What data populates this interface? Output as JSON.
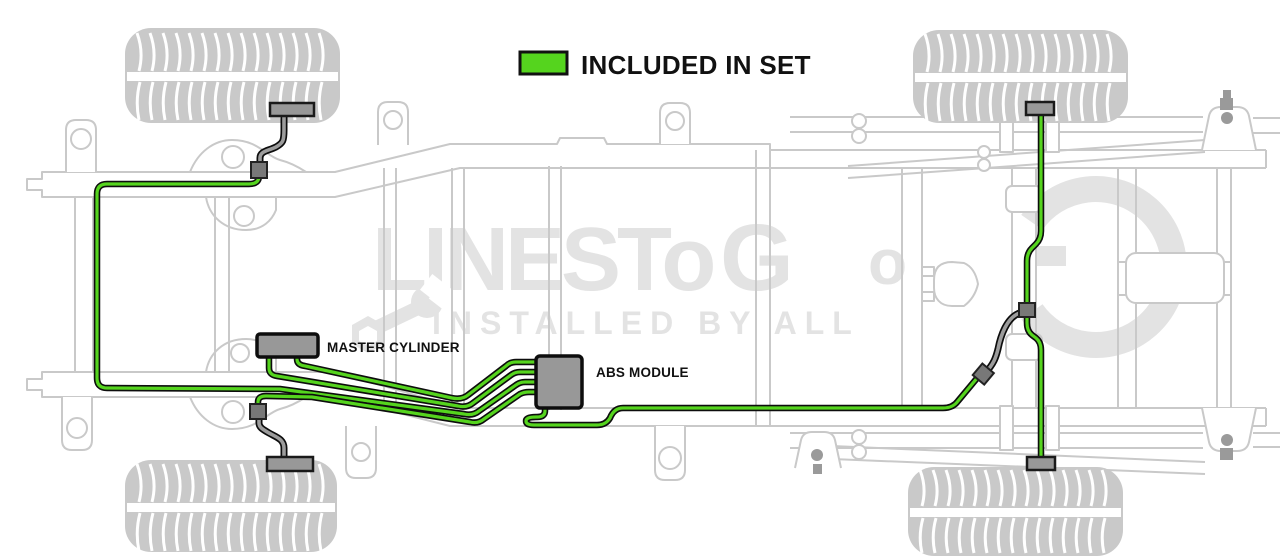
{
  "legend": {
    "label": "INCLUDED IN SET"
  },
  "components": {
    "master_cylinder": {
      "label": "MASTER CYLINDER"
    },
    "abs_module": {
      "label": "ABS MODULE"
    }
  },
  "watermark": {
    "brand_segment_1": "LINESTo",
    "brand_segment_2": "G",
    "brand_segment_3": "o",
    "tagline": "INSTALLED BY ALL"
  },
  "lines": {
    "included_meaning": "green lines are included in set",
    "items": [
      "line-to-upper-front-wheel",
      "line-to-lower-front-wheel",
      "master-cylinder-line-1",
      "master-cylinder-line-2",
      "rear-axle-line",
      "rear-upper-wheel-line",
      "rear-lower-wheel-line"
    ]
  },
  "colors": {
    "included_line": "#55d41e",
    "line_casing": "#0d0d0d",
    "hose_core": "#9c9c9c",
    "component_fill": "#989898",
    "connector_fill": "#787878",
    "hardware_gray": "#9a9a9a",
    "chassis_line": "#c9c9c9",
    "tire_fill": "#c9c9c9",
    "watermark_gray": "#e3e3e3",
    "label_text": "#111111",
    "background": "#ffffff"
  }
}
